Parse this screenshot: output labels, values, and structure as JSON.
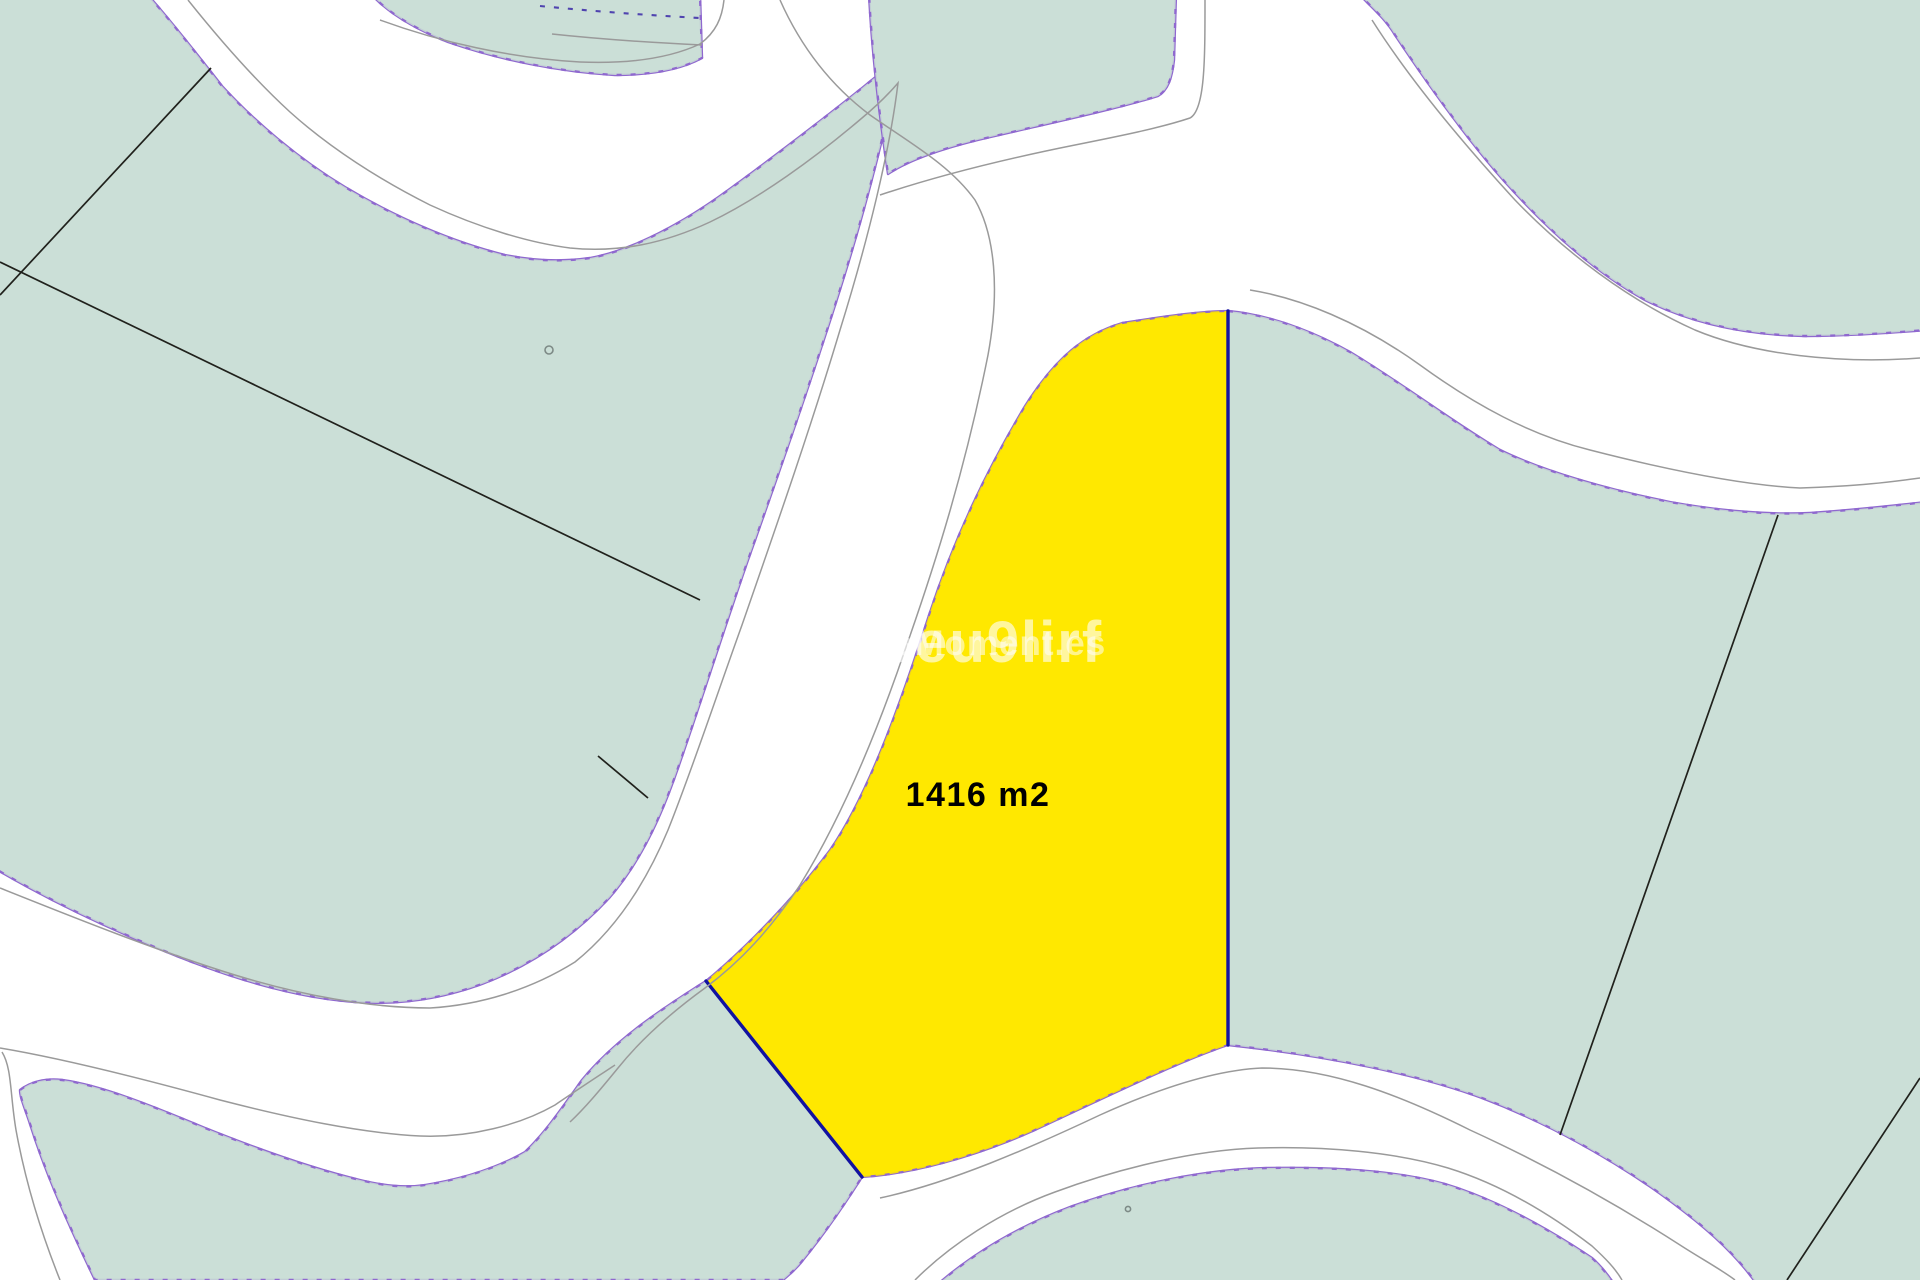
{
  "title": "Cadastral parcel map with highlighted plot",
  "map": {
    "area_label": "1416 m2",
    "watermark_primary": "3eu9lirf",
    "watermark_secondary": "moMoment.es",
    "highlighted_parcel_area_m2": 1416
  },
  "colors": {
    "road-white": "#ffffff",
    "parcel-green": "#cbdfd7",
    "parcel-yellow": "#ffe800",
    "boundary-purple": "#8f68cf",
    "boundary-dash": "#3a28a8",
    "boundary-blue": "#1212a0",
    "subdivision-black": "#20211c",
    "road-line-gray": "#9a9a9a",
    "label-black": "#000000",
    "watermark-white": "#ffffff"
  }
}
